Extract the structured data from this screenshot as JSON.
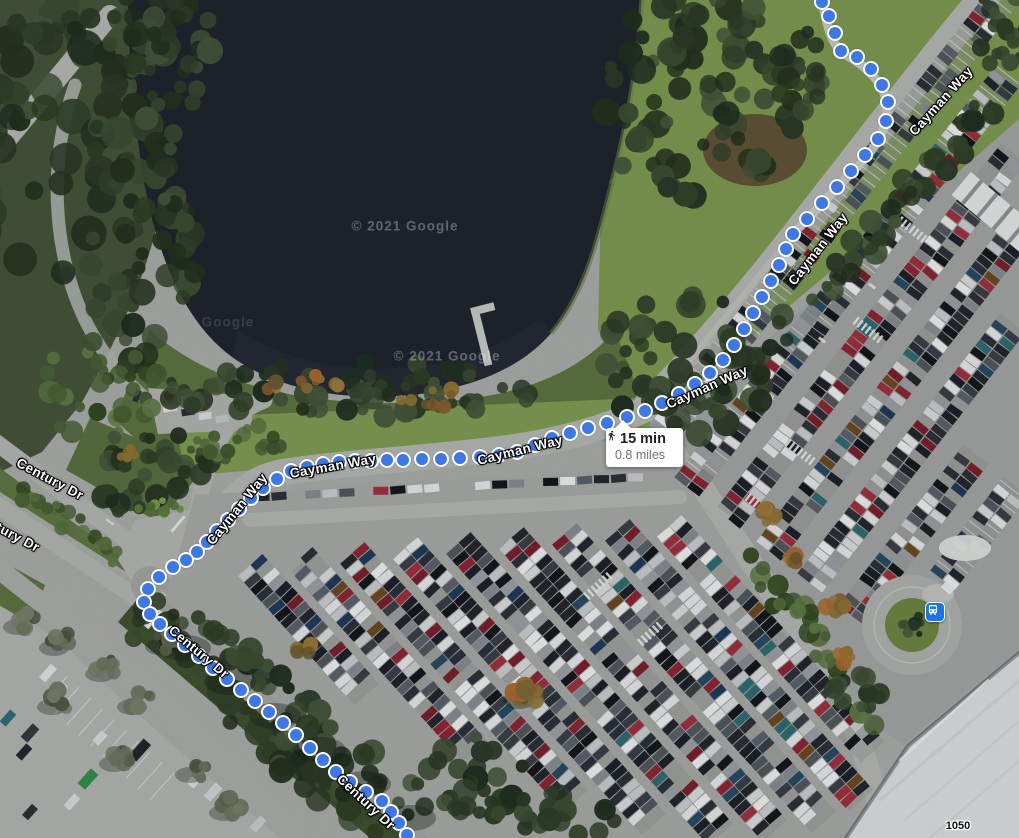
{
  "map": {
    "type": "satellite",
    "watermarks": [
      {
        "text": "© 2021 Google",
        "x": 405,
        "y": 226,
        "dim": false
      },
      {
        "text": "© 2021 Google",
        "x": 447,
        "y": 356,
        "dim": false
      },
      {
        "text": "Google",
        "x": 228,
        "y": 322,
        "dim": true
      }
    ],
    "building_labels": [
      {
        "text": "1050",
        "x": 958,
        "y": 826
      }
    ]
  },
  "route": {
    "mode": "walking",
    "duration": "15 min",
    "distance": "0.8 miles",
    "dot_color": "#3d78e6"
  },
  "road_labels": [
    {
      "text": "Cayman Way",
      "x": 941,
      "y": 101,
      "rot": -48
    },
    {
      "text": "Cayman Way",
      "x": 818,
      "y": 249,
      "rot": -52
    },
    {
      "text": "Cayman Way",
      "x": 707,
      "y": 387,
      "rot": -24
    },
    {
      "text": "Cayman Way",
      "x": 520,
      "y": 450,
      "rot": -14
    },
    {
      "text": "Cayman Way",
      "x": 333,
      "y": 466,
      "rot": -10
    },
    {
      "text": "Cayman Way",
      "x": 237,
      "y": 509,
      "rot": -51
    },
    {
      "text": "Century Dr",
      "x": 50,
      "y": 479,
      "rot": 28
    },
    {
      "text": "Century Dr",
      "x": 6,
      "y": 531,
      "rot": 28
    },
    {
      "text": "Century Dr",
      "x": 199,
      "y": 652,
      "rot": 40
    },
    {
      "text": "Century Dr",
      "x": 366,
      "y": 802,
      "rot": 43
    }
  ],
  "transit_stations": [
    {
      "name": "bus-station",
      "x": 935,
      "y": 612,
      "color": "#1a73e8"
    }
  ]
}
